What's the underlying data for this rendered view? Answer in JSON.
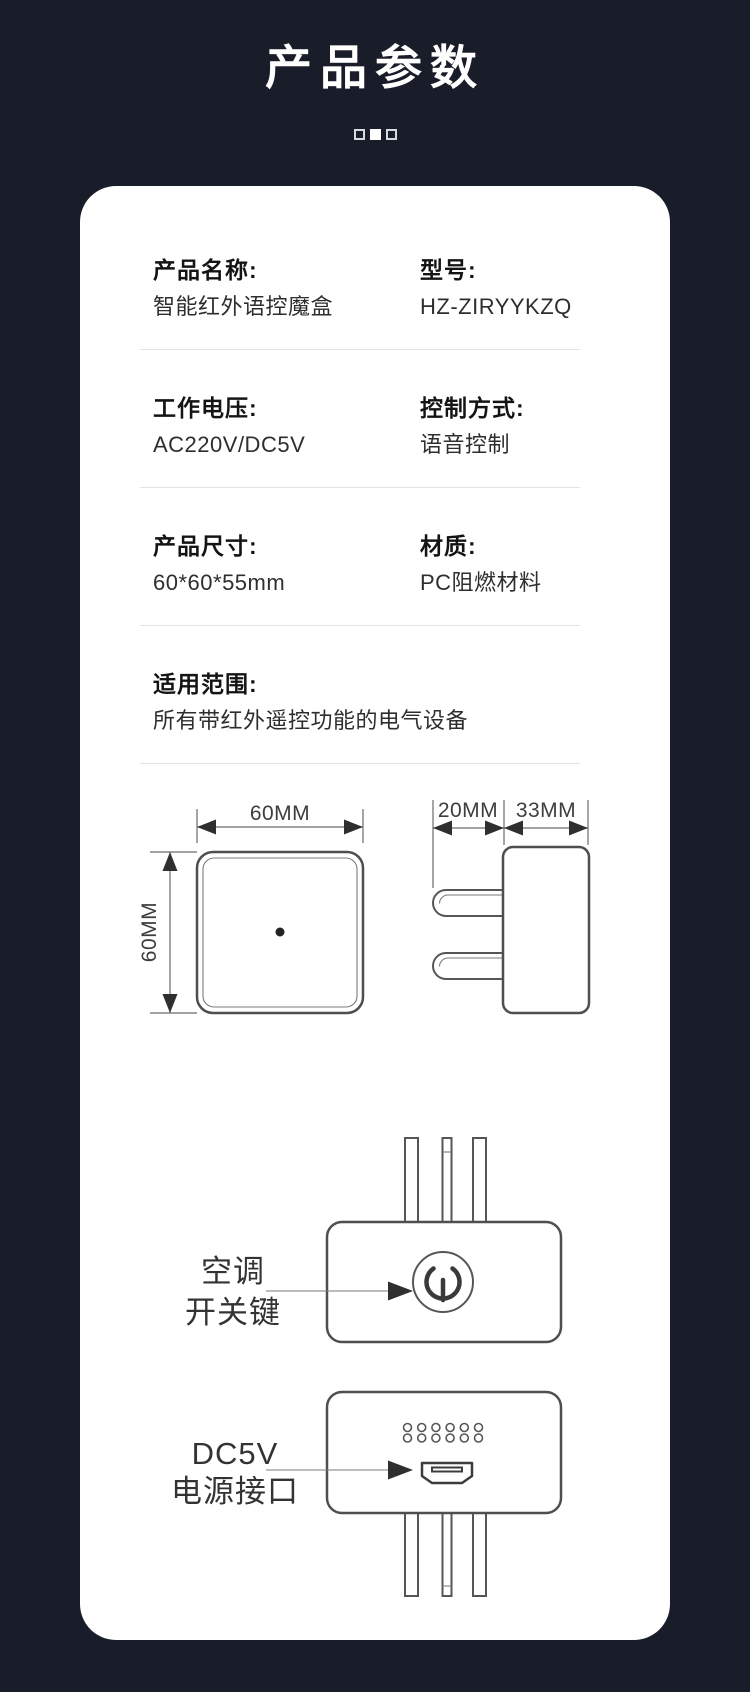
{
  "header": {
    "title": "产品参数"
  },
  "page_indicator": {
    "dots": [
      "outline",
      "filled",
      "outline"
    ]
  },
  "colors": {
    "background": "#191c29",
    "card": "#ffffff",
    "drawing_line": "#565656",
    "divider": "#e3e3e3"
  },
  "specs": {
    "rows": [
      {
        "left_label": "产品名称:",
        "left_value": "智能红外语控魔盒",
        "right_label": "型号:",
        "right_value": "HZ-ZIRYYKZQ"
      },
      {
        "left_label": "工作电压:",
        "left_value": "AC220V/DC5V",
        "right_label": "控制方式:",
        "right_value": "语音控制"
      },
      {
        "left_label": "产品尺寸:",
        "left_value": "60*60*55mm",
        "right_label": "材质:",
        "right_value": "PC阻燃材料"
      }
    ],
    "full_row": {
      "label": "适用范围:",
      "value": "所有带红外遥控功能的电气设备"
    }
  },
  "diagrams": {
    "front_view": {
      "width_label": "60MM",
      "height_label": "60MM"
    },
    "side_view": {
      "pin_label": "20MM",
      "body_label": "33MM"
    },
    "power_view": {
      "callout_line1": "空调",
      "callout_line2": "开关键"
    },
    "usb_view": {
      "callout_line1": "DC5V",
      "callout_line2": "电源接口"
    }
  }
}
